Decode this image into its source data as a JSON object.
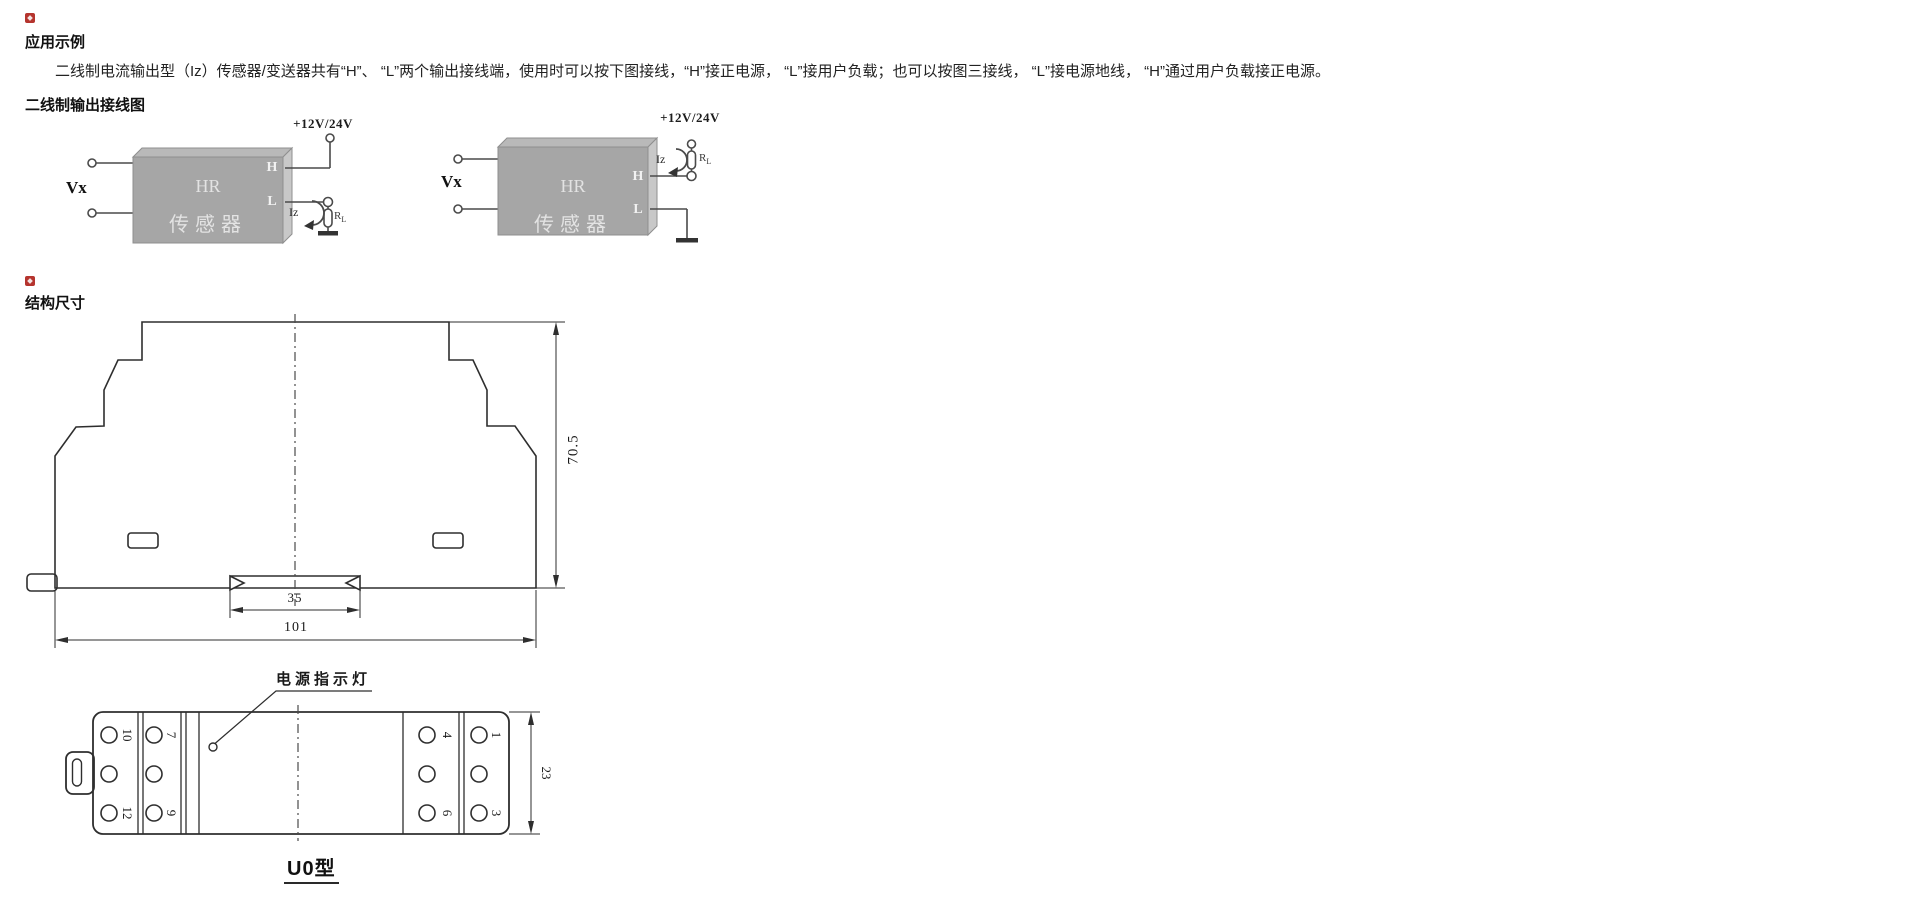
{
  "sections": {
    "application": {
      "title": "应用示例",
      "body": "二线制电流输出型（Iz）传感器/变送器共有“H”、 “L”两个输出接线端，使用时可以按下图接线，“H”接正电源， “L”接用户负载；也可以按图三接线， “L”接电源地线， “H”通过用户负载接正电源。",
      "subtitle": "二线制输出接线图"
    },
    "structure": {
      "title": "结构尺寸"
    }
  },
  "wiring_diagrams": {
    "left": {
      "input_label": "Vx",
      "power_label": "+12V/24V",
      "terminal_h": "H",
      "terminal_l": "L",
      "current_label": "Iz",
      "load_label": "R",
      "load_sub": "L",
      "device_line1": "HR",
      "device_line2": "传感器"
    },
    "right": {
      "input_label": "Vx",
      "power_label": "+12V/24V",
      "terminal_h": "H",
      "terminal_l": "L",
      "current_label": "Iz",
      "load_label": "R",
      "load_sub": "L",
      "device_line1": "HR",
      "device_line2": "传感器"
    }
  },
  "front_view": {
    "dim_height": "70.5",
    "dim_rail_width": "35",
    "dim_total_width": "101"
  },
  "bottom_view": {
    "led_label": "电源指示灯",
    "dim_depth": "23",
    "caption": "U0型",
    "terminals": {
      "n10": "10",
      "n12": "12",
      "n7": "7",
      "n9": "9",
      "n4": "4",
      "n6": "6",
      "n1": "1",
      "n3": "3"
    }
  },
  "colors": {
    "accent_red": "#b5342e",
    "line": "#333333",
    "box_front": "#a6a6a6",
    "box_top": "#b9b9b9",
    "box_side": "#c8c8c8",
    "box_text": "#e3e3e3"
  }
}
